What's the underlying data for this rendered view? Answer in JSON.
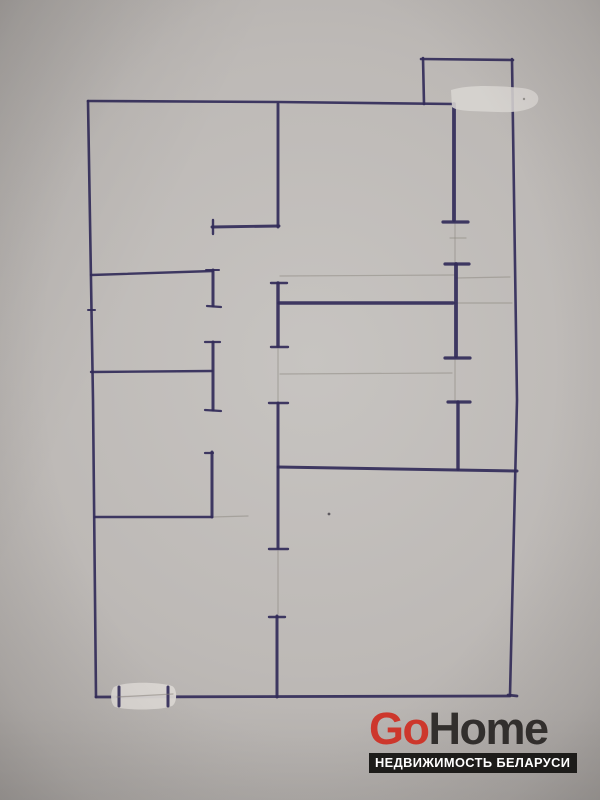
{
  "watermark": {
    "brand_go": "Go",
    "brand_home": "Home",
    "tagline": "НЕДВИЖИМОСТЬ БЕЛАРУСИ",
    "colors": {
      "go": "#cd372c",
      "home": "#322f2d",
      "bar_bg": "#1d1c1a",
      "bar_text": "#ffffff"
    }
  },
  "plan": {
    "ink_color": "#322b59",
    "pencil_color": "#8a857e",
    "paper_color": "#bdb9b6",
    "walls": [
      {
        "pts": "88,101 93,400 96,697",
        "w": 2.6
      },
      {
        "pts": "88,101 278,102 454,104",
        "w": 2.6
      },
      {
        "pts": "96,697 510,696",
        "w": 2.8
      },
      {
        "pts": "512,59 517,400 510,695",
        "w": 2.6
      },
      {
        "pts": "508,695 517,696",
        "w": 2.8
      },
      {
        "pts": "423,58 424,104",
        "w": 2.6
      },
      {
        "pts": "421,59 513,60",
        "w": 2.6
      },
      {
        "pts": "278,104 278,227",
        "w": 2.9
      },
      {
        "pts": "212,227 279,226",
        "w": 2.9
      },
      {
        "pts": "213,220 213,234",
        "w": 2.4
      },
      {
        "pts": "454,104 454,220",
        "w": 3.8
      },
      {
        "pts": "443,222 468,222",
        "w": 3.2
      },
      {
        "pts": "445,264 469,264",
        "w": 3.2
      },
      {
        "pts": "456,264 456,356",
        "w": 3.8
      },
      {
        "pts": "445,358 470,358",
        "w": 3.2
      },
      {
        "pts": "448,402 470,402",
        "w": 3.2
      },
      {
        "pts": "458,402 458,469",
        "w": 3.4
      },
      {
        "pts": "279,303 453,303",
        "w": 3.4
      },
      {
        "pts": "271,283 287,283",
        "w": 2.4
      },
      {
        "pts": "278,283 278,346",
        "w": 3.4
      },
      {
        "pts": "271,347 288,347",
        "w": 2.4
      },
      {
        "pts": "278,467 517,471",
        "w": 3.0
      },
      {
        "pts": "269,403 288,403",
        "w": 2.4
      },
      {
        "pts": "278,403 278,548",
        "w": 3.0
      },
      {
        "pts": "269,549 288,549",
        "w": 2.4
      },
      {
        "pts": "277,616 277,697",
        "w": 3.0
      },
      {
        "pts": "269,617 285,617",
        "w": 2.4
      },
      {
        "pts": "91,275 213,271",
        "w": 2.4
      },
      {
        "pts": "213,270 213,306",
        "w": 3.0
      },
      {
        "pts": "206,270 219,270",
        "w": 2.0
      },
      {
        "pts": "207,306 221,307",
        "w": 2.2
      },
      {
        "pts": "91,372 212,371",
        "w": 2.4
      },
      {
        "pts": "213,342 213,410",
        "w": 3.0
      },
      {
        "pts": "205,342 220,342",
        "w": 2.2
      },
      {
        "pts": "205,410 221,411",
        "w": 2.2
      },
      {
        "pts": "212,452 212,517",
        "w": 3.0
      },
      {
        "pts": "205,453 213,453",
        "w": 2.2
      },
      {
        "pts": "95,517 212,517",
        "w": 2.6
      },
      {
        "pts": "88,310 95,310",
        "w": 2.0
      }
    ],
    "pencil_lines": [
      {
        "pts": "280,276 454,275"
      },
      {
        "pts": "455,303 512,303"
      },
      {
        "pts": "455,224 455,262"
      },
      {
        "pts": "455,360 455,400"
      },
      {
        "pts": "278,349 278,401"
      },
      {
        "pts": "278,551 278,614"
      },
      {
        "pts": "212,517 248,516"
      },
      {
        "pts": "450,238 466,238"
      },
      {
        "pts": "456,278 510,277"
      },
      {
        "pts": "280,374 452,373"
      }
    ],
    "whiteout_patches": [
      {
        "d": "M451,90 C470,84 500,86 522,88 C533,89 540,94 538,101 C536,109 520,113 498,112 C478,111 458,112 452,107 Z",
        "fill": "#d8d5d1",
        "opacity": 0.88
      },
      {
        "d": "M114,687 C125,681 160,682 172,686 C177,688 178,702 172,706 C158,711 125,710 115,707 C110,704 110,691 114,687 Z",
        "fill": "#dad7d3",
        "opacity": 0.95
      }
    ],
    "overlay_ticks": [
      {
        "pts": "119,687 119,706",
        "w": 3.0
      },
      {
        "pts": "168,687 168,706",
        "w": 3.0
      }
    ],
    "overlay_pencil": [
      {
        "pts": "117,697 173,694"
      }
    ],
    "specks": [
      {
        "cx": 329,
        "cy": 514,
        "r": 1.4,
        "fill": "#45414a",
        "opacity": 0.8
      },
      {
        "cx": 524,
        "cy": 99,
        "r": 1.2,
        "fill": "#8d8a86",
        "opacity": 0.9
      }
    ]
  }
}
